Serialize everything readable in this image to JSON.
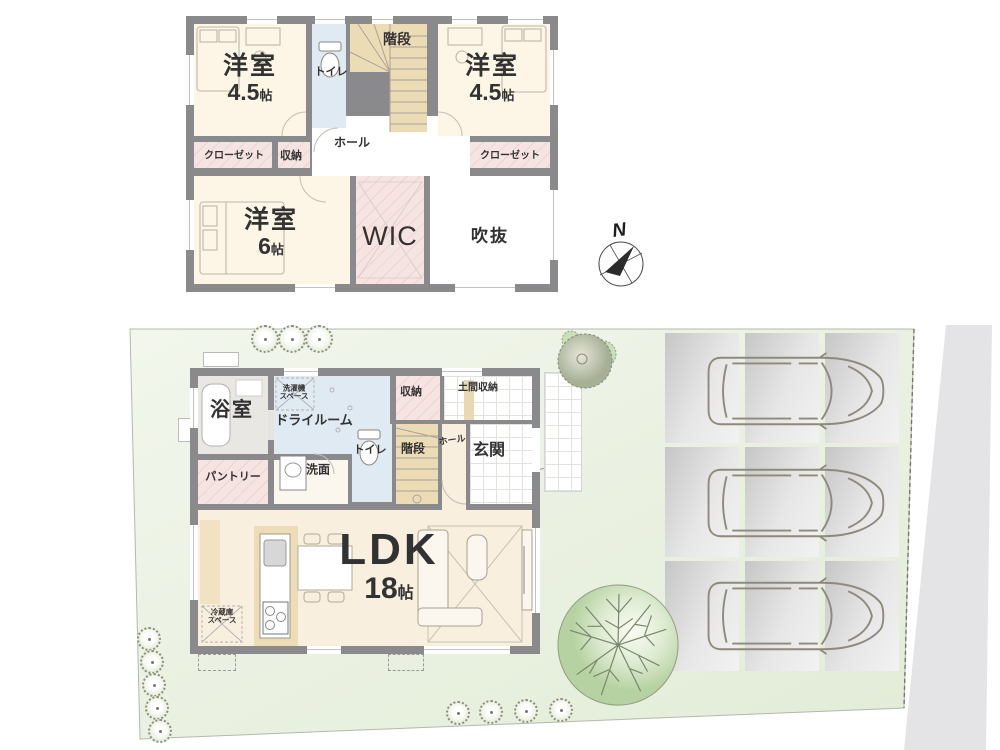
{
  "floor2": {
    "bedroom_left": {
      "name": "洋室",
      "num": "4.5",
      "unit": "帖"
    },
    "bedroom_right": {
      "name": "洋室",
      "num": "4.5",
      "unit": "帖"
    },
    "bedroom_large": {
      "name": "洋室",
      "num": "6",
      "unit": "帖"
    },
    "toilet": "トイレ",
    "stairs": "階段",
    "hall": "ホール",
    "closet_left": "クローゼット",
    "closet_right": "クローゼット",
    "storage": "収納",
    "wic": "WIC",
    "void": "吹抜"
  },
  "floor1": {
    "bath": "浴室",
    "dry_room": "ドライルーム",
    "laundry_space_line1": "洗濯機",
    "laundry_space_line2": "スペース",
    "storage": "収納",
    "doma_storage": "土間収納",
    "toilet": "トイレ",
    "stairs": "階段",
    "hall": "ホール",
    "entrance": "玄関",
    "pantry": "パントリー",
    "washroom": "洗面",
    "ldk": {
      "name": "LDK",
      "num": "18",
      "unit": "帖"
    },
    "fridge_space_line1": "冷蔵庫",
    "fridge_space_line2": "スペース"
  },
  "compass": {
    "north": "N"
  },
  "colors": {
    "wall": "#8a8a8c",
    "room_cream": "#fdf6e6",
    "ldk_cream": "#f8efde",
    "closet_pink": "#f6e4e2",
    "water_blue": "#e0eaf3",
    "stair_tan": "#ecdcb6",
    "site_green": "#ecf2e5",
    "parking_gray": "#d9d9d9",
    "road_gray": "#e4e4e6",
    "tree_green": "#c3d8b0"
  }
}
